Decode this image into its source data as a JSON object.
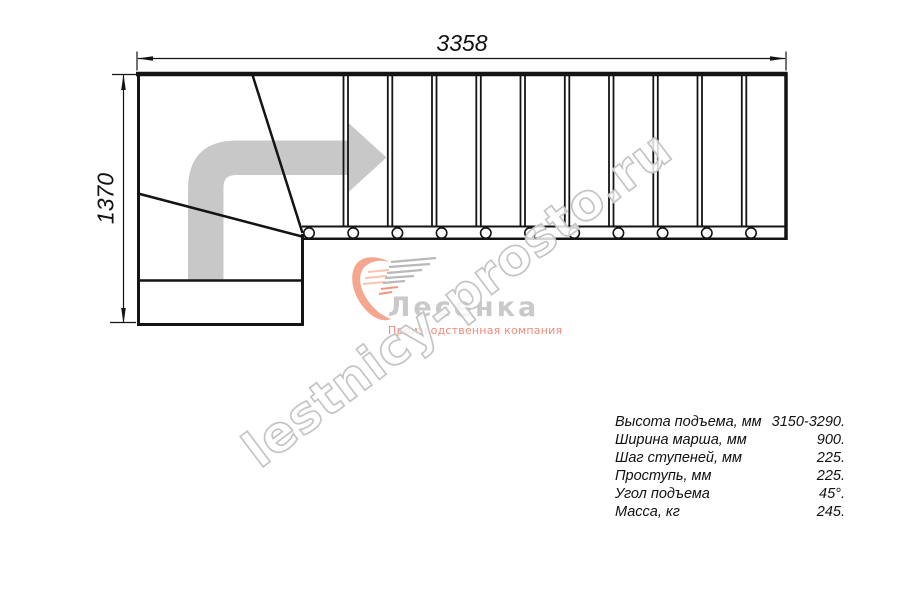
{
  "drawing": {
    "type": "staircase-plan",
    "width_dimension_mm": "3358",
    "height_dimension_mm": "1370",
    "straight_treads_count": 11,
    "baluster_count": 11
  },
  "logo": {
    "brand": "Лесенка",
    "tagline": "Производственная компания"
  },
  "watermark": {
    "text": "lestnicy-prosto.ru"
  },
  "specs": {
    "rows": [
      {
        "label": "Высота подъема, мм",
        "value": "3150-3290."
      },
      {
        "label": "Ширина марша, мм",
        "value": "900."
      },
      {
        "label": "Шаг ступеней, мм",
        "value": "225."
      },
      {
        "label": "Проступь, мм",
        "value": "225."
      },
      {
        "label": "Угол подъема",
        "value": "45°."
      },
      {
        "label": "Масса, кг",
        "value": "245."
      }
    ]
  },
  "colors": {
    "line": "#141414",
    "arrow_fill": "#c8c8c8",
    "brand_text": "#c9c9c9",
    "tagline_text": "#ef8b7a",
    "logo_salmon": "#f5a68e",
    "logo_gray_lines": "#b9b9b9",
    "watermark_stroke": "#c5c5c5"
  }
}
